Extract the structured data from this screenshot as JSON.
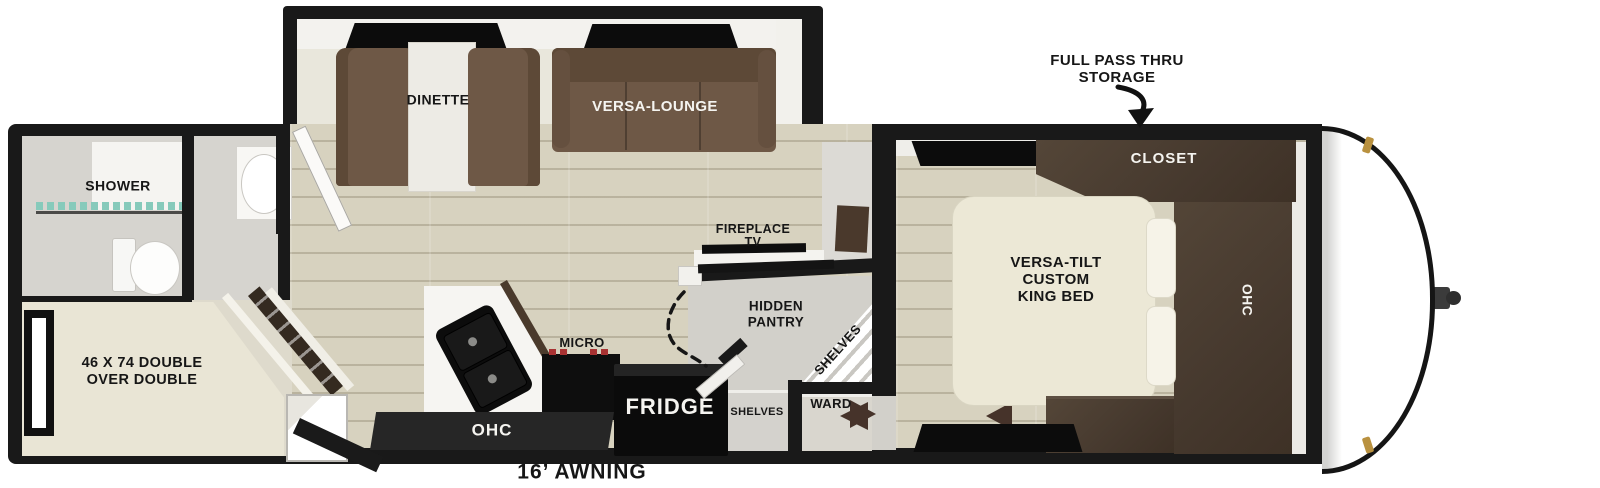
{
  "title": "Travel trailer floor plan",
  "colors": {
    "wall": "#191919",
    "wood_floor": "#d7d2bf",
    "slide_floor": "#e9e7dc",
    "upholstery_brown": "#6e5846",
    "upholstery_dark": "#5d4937",
    "cabinetry_dark": "#4a3e33",
    "mattress_cream": "#ece8d6",
    "counter_white": "#f6f5f2",
    "appliance_black": "#0d0d0d",
    "hall_gray": "#d2d0ca",
    "shower_glass_teal": "#86cabb",
    "clearance_light_gold": "#b9913f",
    "burner_red": "#a83232",
    "door_triangle_brown": "#46332a"
  },
  "annotations": {
    "storage_line1": "FULL PASS THRU",
    "storage_line2": "STORAGE",
    "awning": "16’ AWNING"
  },
  "slideout": {
    "dinette": "DINETTE",
    "versa_lounge": "VERSA-LOUNGE"
  },
  "bathroom": {
    "shower": "SHOWER"
  },
  "bunkroom": {
    "bed_line1": "46 X 74 DOUBLE",
    "bed_line2": "OVER DOUBLE"
  },
  "kitchen": {
    "micro": "MICRO",
    "fridge": "FRIDGE",
    "ohc": "OHC"
  },
  "entertainment": {
    "fireplace_line1": "FIREPLACE",
    "fireplace_line2": "TV"
  },
  "pantry": {
    "hidden_line1": "HIDDEN",
    "hidden_line2": "PANTRY",
    "shelves_diagonal": "SHELVES",
    "shelves_hall": "SHELVES",
    "ward": "WARD"
  },
  "bedroom": {
    "closet": "CLOSET",
    "ohc": "OHC",
    "bed_line1": "VERSA-TILT",
    "bed_line2": "CUSTOM",
    "bed_line3": "KING BED"
  }
}
